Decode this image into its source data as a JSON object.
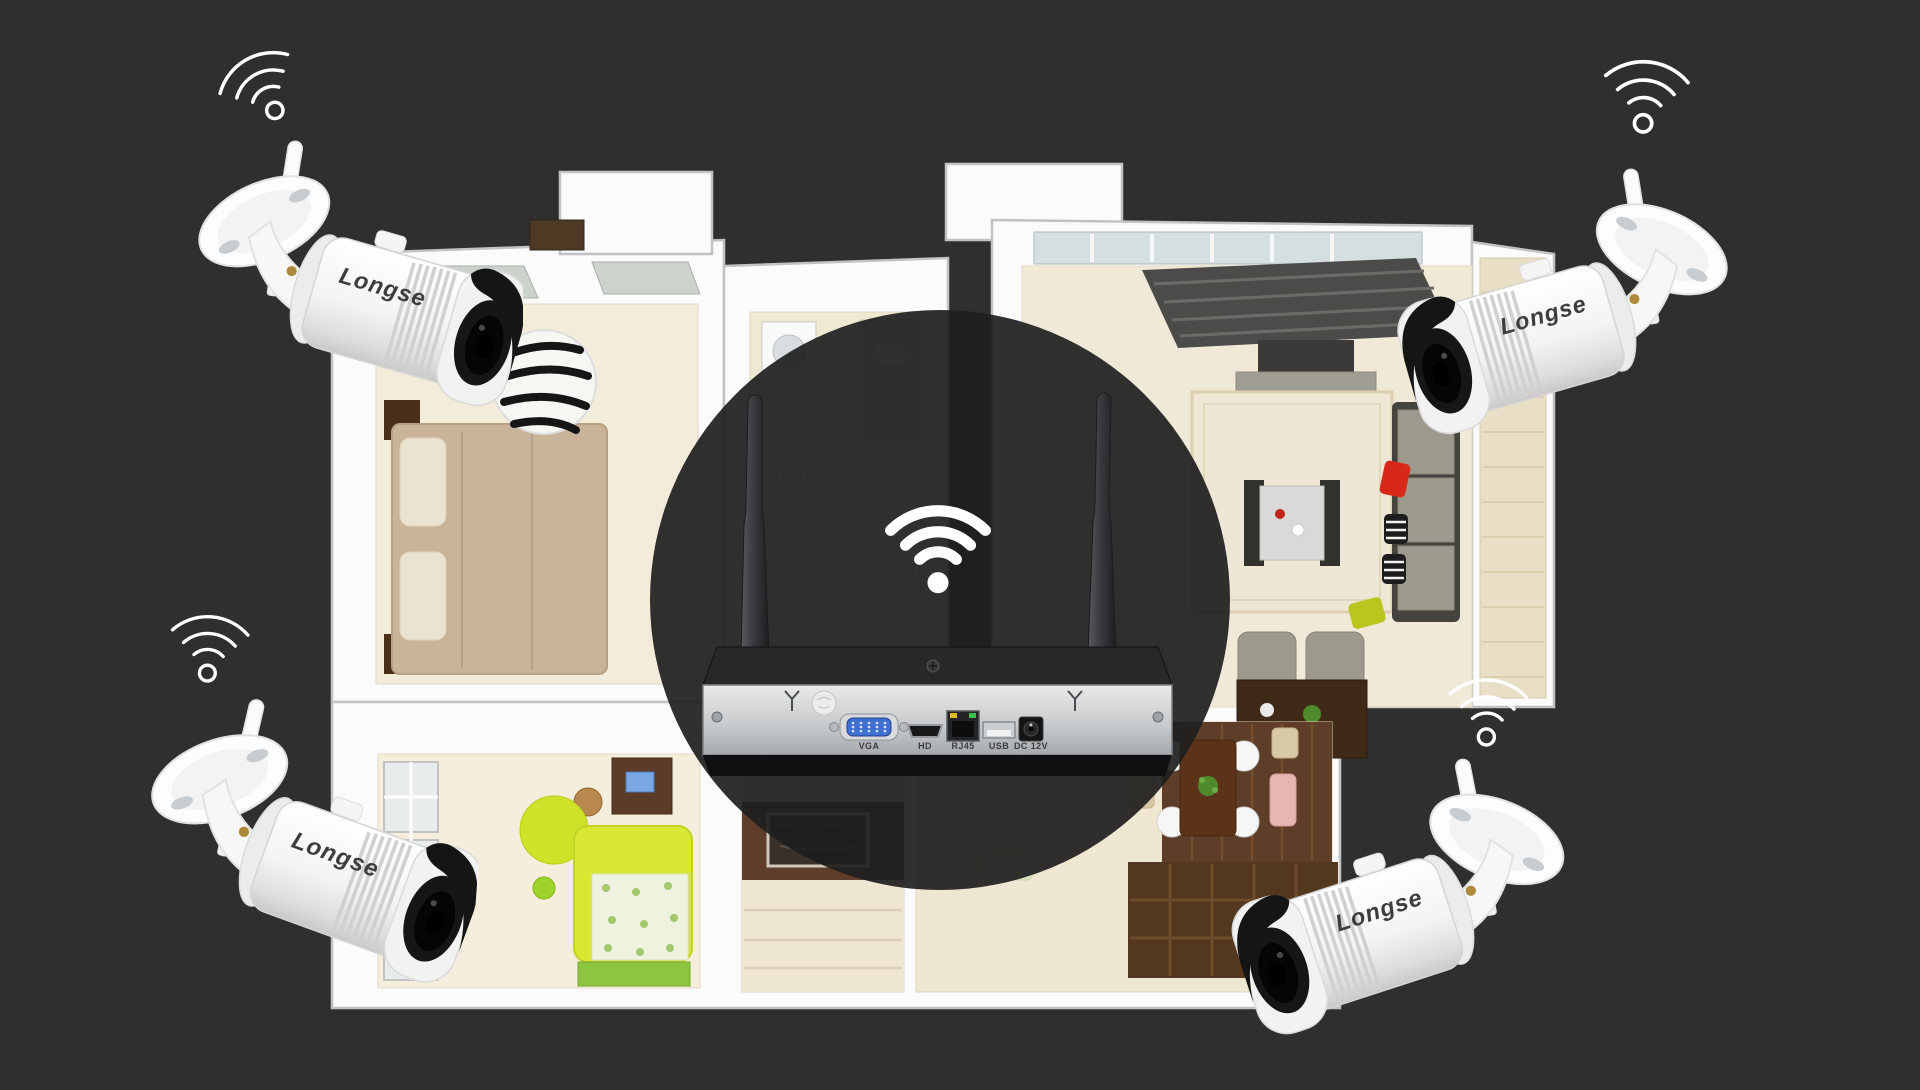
{
  "scene": {
    "background_color": "#2f2f2f",
    "overlay_circle_color": "#1e1e1e",
    "overlay_opacity": 0.92
  },
  "brand": "Longse",
  "cameras": [
    {
      "position": "top-left",
      "brand": "Longse"
    },
    {
      "position": "top-right",
      "brand": "Longse"
    },
    {
      "position": "bottom-left",
      "brand": "Longse"
    },
    {
      "position": "bottom-right",
      "brand": "Longse"
    }
  ],
  "nvr": {
    "antenna_count": 2,
    "ports": [
      {
        "label": "VGA"
      },
      {
        "label": "HD"
      },
      {
        "label": "RJ45"
      },
      {
        "label": "USB"
      },
      {
        "label": "DC 12V"
      }
    ]
  },
  "wifi_icons": [
    {
      "location": "top-left",
      "style": "outline-dot"
    },
    {
      "location": "top-right",
      "style": "outline-dot"
    },
    {
      "location": "bottom-left",
      "style": "outline-dot"
    },
    {
      "location": "bottom-right",
      "style": "outline-dot"
    },
    {
      "location": "center",
      "style": "filled-dot"
    }
  ],
  "colors": {
    "background": "#2f2f2f",
    "camera_body": "#ffffff",
    "brand_text": "#3d3d3d",
    "wifi_icon": "#ffffff",
    "nvr_panel": "#c6c9cb",
    "nvr_body": "#222222",
    "port_label": "#3b3b3b",
    "floor_cream": "#f3ecdb",
    "floor_wood_dark": "#5e3e2a",
    "accent_red": "#d7281a",
    "accent_chartreuse": "#d9e833",
    "accent_green_rug": "#8cc53e",
    "accent_pink": "#e7b6b4"
  }
}
